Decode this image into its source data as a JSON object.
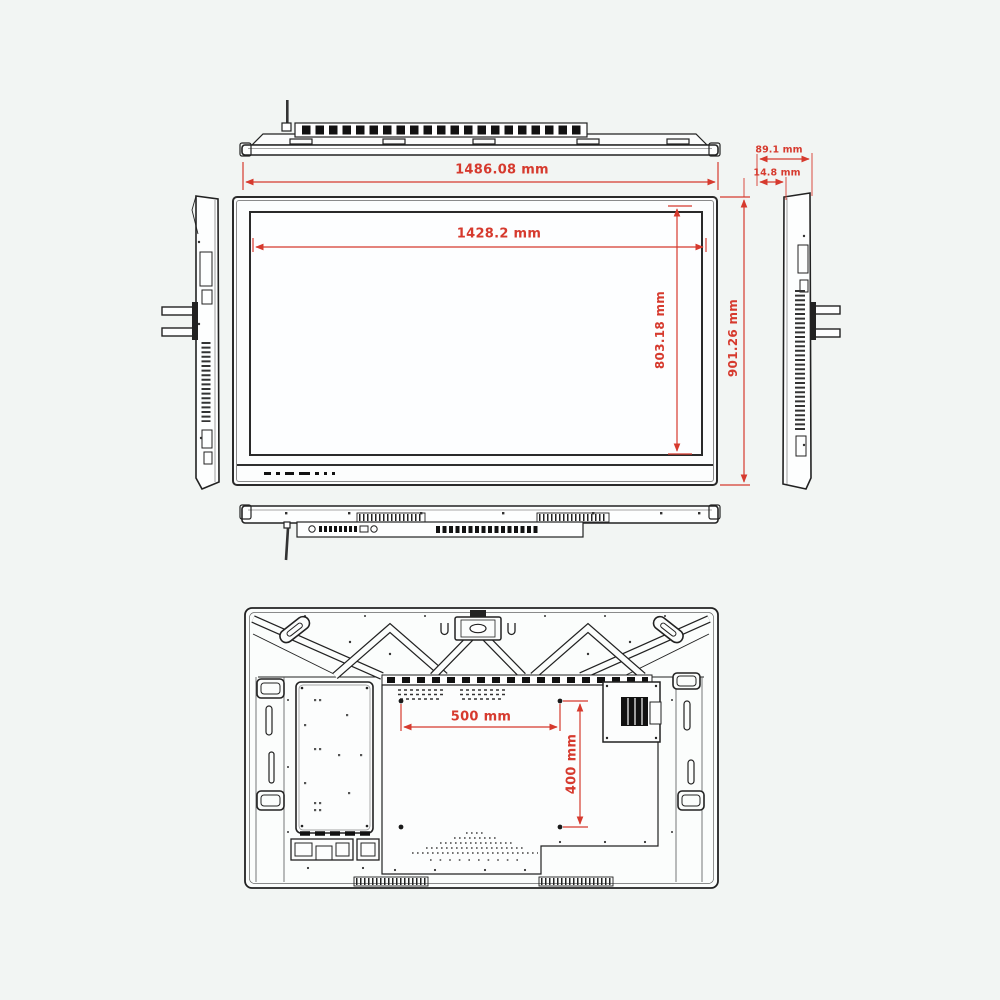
{
  "colors": {
    "background": "#f2f5f3",
    "line": "#222222",
    "dimension_red": "#d63a2e"
  },
  "dimensions": {
    "overall_width": "1486.08 mm",
    "active_width": "1428.2 mm",
    "active_height": "803.18 mm",
    "overall_height": "901.26 mm",
    "side_depth_total": "89.1 mm",
    "side_depth_front": "14.8 mm",
    "vesa_horizontal": "500 mm",
    "vesa_vertical": "400 mm"
  }
}
